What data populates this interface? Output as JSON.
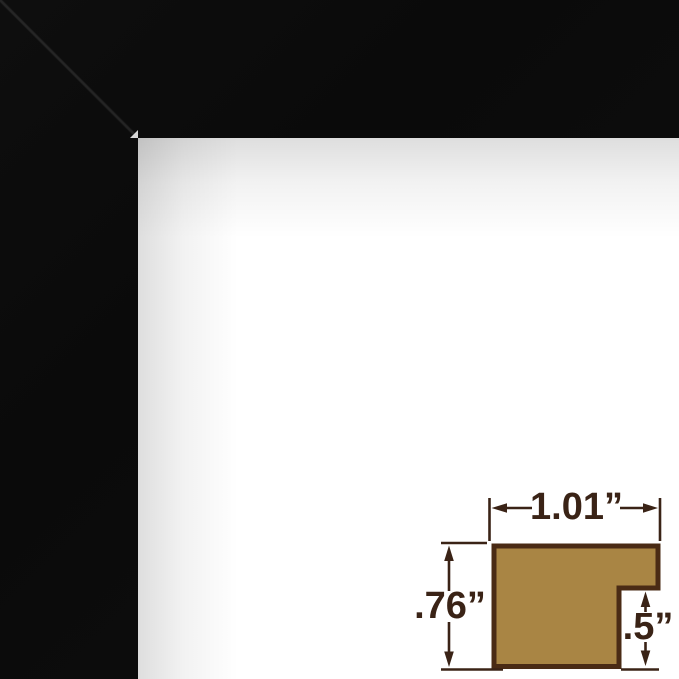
{
  "frame_photo": {
    "frame_color": "#0b0b0b",
    "background_color": "#ffffff"
  },
  "dimension_diagram": {
    "width_label": "1.01”",
    "height_label": ".76”",
    "rabbet_label": ".5”",
    "colors": {
      "profile_fill": "#a98544",
      "profile_outline": "#4a2b15",
      "annotation": "#3a2316"
    }
  }
}
